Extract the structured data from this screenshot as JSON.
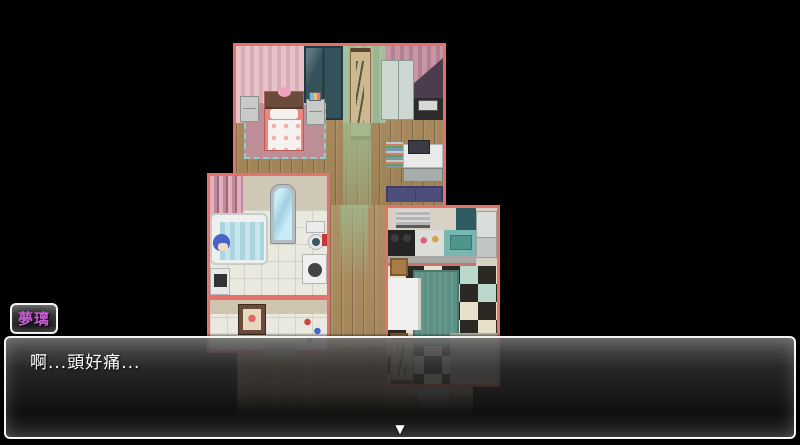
{
  "dialogue": {
    "speaker_name": "夢璃",
    "message": "啊...頭好痛...",
    "continue_indicator": "▼"
  },
  "palette": {
    "background": "#000000",
    "room_wall_border": "#e5716d",
    "window_border": "#ffffff",
    "window_background": "#1a1a1a",
    "speaker_name_color": "#c75ed4",
    "message_text_color": "#ffffff",
    "wood_floor": "#ab8b5c",
    "bathroom_tile": "#eae9e0",
    "checker_dark": "#2c2823",
    "checker_light": "#e8e0c8",
    "kitchen_rug_teal": "#5d9186",
    "bedroom_rug_pink": "#bd8e96",
    "sofa_blue": "#4e4e7c",
    "bath_water_teal": "#aad4de",
    "character_hair_blue": "#4763c8"
  }
}
